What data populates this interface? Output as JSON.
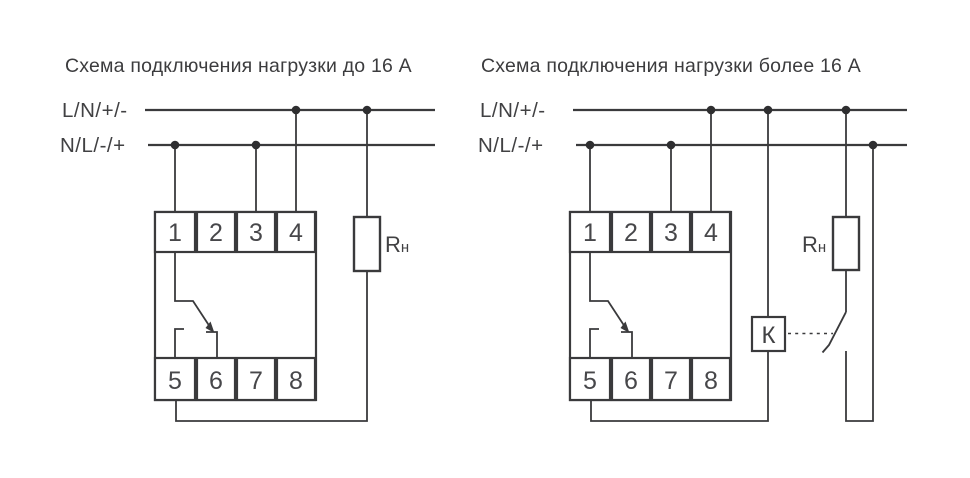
{
  "colors": {
    "background": "#ffffff",
    "line": "#3a3a3c",
    "text": "#3c3c3e",
    "junction_dot": "#2e2e30"
  },
  "diagrams": [
    {
      "title": "Схема подключения нагрузки до 16 А",
      "bus_top_label": "L/N/+/-",
      "bus_bottom_label": "N/L/-/+",
      "terminals_top": [
        "1",
        "2",
        "3",
        "4"
      ],
      "terminals_bottom": [
        "5",
        "6",
        "7",
        "8"
      ],
      "load_label": {
        "main": "R",
        "sub": "н"
      }
    },
    {
      "title": "Схема подключения нагрузки более 16 А",
      "bus_top_label": "L/N/+/-",
      "bus_bottom_label": "N/L/-/+",
      "terminals_top": [
        "1",
        "2",
        "3",
        "4"
      ],
      "terminals_bottom": [
        "5",
        "6",
        "7",
        "8"
      ],
      "load_label": {
        "main": "R",
        "sub": "н"
      },
      "contactor_label": "К"
    }
  ]
}
